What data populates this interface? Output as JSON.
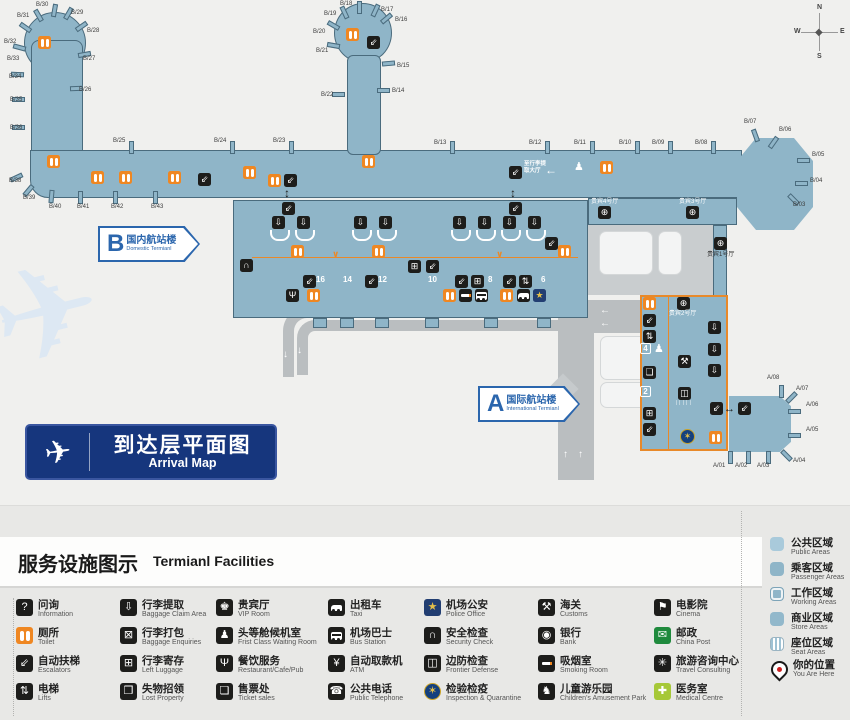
{
  "colors": {
    "terminal_fill": "#8fb5c8",
    "terminal_border": "#4a6b7d",
    "toilet_orange": "#ef8722",
    "road_gray": "#babec0",
    "banner_navy": "#16367d",
    "label_blue": "#2b66ad",
    "legend_bg": "#e8e8e6",
    "post_green": "#1f8a3d",
    "medical_green": "#a6c838"
  },
  "map": {
    "compass": {
      "n": "N",
      "e": "E",
      "s": "S",
      "w": "W"
    },
    "banner": {
      "zh": "到达层平面图",
      "en": "Arrival Map"
    },
    "terminal_b": {
      "letter": "B",
      "zh": "国内航站楼",
      "en": "Domestic Termianl"
    },
    "terminal_a": {
      "letter": "A",
      "zh": "国际航站楼",
      "en": "International Termianl"
    },
    "wayfinding_baggage": "至行李提\n取大厅",
    "frontier_hatch": "∣∣∣∣∣",
    "gates": [
      [
        "B/30",
        36,
        2,
        52,
        4,
        10
      ],
      [
        "B/31",
        17,
        13,
        36,
        9,
        -30
      ],
      [
        "B/29",
        71,
        10,
        66,
        7,
        30
      ],
      [
        "B/32",
        4,
        39,
        23,
        21,
        -55
      ],
      [
        "B/28",
        87,
        28,
        79,
        20,
        55
      ],
      [
        "B/33",
        7,
        56,
        17,
        41,
        -75
      ],
      [
        "B/27",
        83,
        56,
        82,
        48,
        80
      ],
      [
        "B/34",
        9,
        74,
        15,
        68,
        -88
      ],
      [
        "B/26",
        79,
        87,
        74,
        82,
        88
      ],
      [
        "B/35",
        10,
        97,
        16,
        93,
        -90
      ],
      [
        "B/36",
        10,
        125,
        16,
        121,
        -90
      ],
      [
        "B/38",
        9,
        178,
        14,
        171,
        -115
      ],
      [
        "B/39",
        23,
        195,
        26,
        184,
        -140
      ],
      [
        "B/40",
        49,
        204,
        49,
        190,
        -175
      ],
      [
        "B/41",
        77,
        204,
        78,
        191,
        180
      ],
      [
        "B/42",
        111,
        204,
        113,
        191,
        180
      ],
      [
        "B/43",
        151,
        204,
        153,
        191,
        180
      ],
      [
        "B/25",
        113,
        138,
        129,
        141,
        0
      ],
      [
        "B/24",
        214,
        138,
        230,
        141,
        0
      ],
      [
        "B/23",
        273,
        138,
        289,
        141,
        0
      ],
      [
        "B/18",
        340,
        1,
        357,
        1,
        0
      ],
      [
        "B/17",
        381,
        7,
        373,
        4,
        25
      ],
      [
        "B/19",
        324,
        11,
        342,
        6,
        -25
      ],
      [
        "B/16",
        395,
        17,
        384,
        12,
        50
      ],
      [
        "B/20",
        313,
        29,
        331,
        19,
        -60
      ],
      [
        "B/21",
        316,
        48,
        331,
        39,
        -80
      ],
      [
        "B/15",
        397,
        63,
        386,
        57,
        85
      ],
      [
        "B/22",
        321,
        92,
        336,
        88,
        -90
      ],
      [
        "B/14",
        392,
        88,
        381,
        84,
        90
      ],
      [
        "B/13",
        434,
        140,
        450,
        141,
        0
      ],
      [
        "B/12",
        529,
        140,
        545,
        141,
        0
      ],
      [
        "B/11",
        574,
        140,
        590,
        141,
        0
      ],
      [
        "B/10",
        619,
        140,
        635,
        141,
        0
      ],
      [
        "B/09",
        652,
        140,
        668,
        141,
        0
      ],
      [
        "B/08",
        695,
        140,
        711,
        141,
        0
      ],
      [
        "B/07",
        744,
        119,
        753,
        129,
        -20
      ],
      [
        "B/06",
        779,
        127,
        771,
        136,
        35
      ],
      [
        "B/05",
        812,
        152,
        801,
        154,
        90
      ],
      [
        "B/04",
        810,
        178,
        799,
        177,
        90
      ],
      [
        "B/03",
        793,
        202,
        791,
        193,
        135
      ],
      [
        "A/08",
        767,
        375,
        779,
        385,
        0
      ],
      [
        "A/07",
        796,
        386,
        789,
        391,
        45
      ],
      [
        "A/06",
        806,
        402,
        792,
        405,
        90
      ],
      [
        "A/05",
        806,
        427,
        792,
        429,
        90
      ],
      [
        "A/04",
        793,
        458,
        784,
        449,
        135
      ],
      [
        "A/03",
        757,
        463,
        766,
        451,
        180
      ],
      [
        "A/02",
        735,
        463,
        746,
        451,
        180
      ],
      [
        "A/01",
        713,
        463,
        728,
        451,
        180
      ]
    ],
    "icons": [
      [
        "wc",
        38,
        36
      ],
      [
        "wc",
        47,
        155
      ],
      [
        "wc",
        91,
        171
      ],
      [
        "wc",
        119,
        171
      ],
      [
        "wc",
        168,
        171
      ],
      [
        "esc",
        198,
        173
      ],
      [
        "wc",
        243,
        166
      ],
      [
        "wc",
        268,
        174
      ],
      [
        "esc",
        284,
        174
      ],
      [
        "wc",
        346,
        28
      ],
      [
        "esc",
        367,
        36
      ],
      [
        "wc",
        362,
        155
      ],
      [
        "esc",
        509,
        166
      ],
      [
        "arrowL",
        545,
        164
      ],
      [
        "person",
        574,
        162
      ],
      [
        "wc",
        600,
        161
      ],
      [
        "updown",
        284,
        187
      ],
      [
        "updown",
        510,
        187
      ],
      [
        "esc",
        282,
        202
      ],
      [
        "esc",
        509,
        202
      ],
      [
        "bag",
        272,
        216
      ],
      [
        "bag",
        297,
        216
      ],
      [
        "bag",
        354,
        216
      ],
      [
        "bag",
        379,
        216
      ],
      [
        "bag",
        453,
        216
      ],
      [
        "bag",
        478,
        216
      ],
      [
        "bag",
        503,
        216
      ],
      [
        "bag",
        528,
        216
      ],
      [
        "wc",
        291,
        245
      ],
      [
        "wc",
        372,
        245
      ],
      [
        "wc",
        558,
        245
      ],
      [
        "aD",
        332,
        250
      ],
      [
        "aD",
        496,
        250
      ],
      [
        "sec",
        240,
        259
      ],
      [
        "lug",
        408,
        260
      ],
      [
        "esc",
        426,
        260
      ],
      [
        "esc",
        303,
        275
      ],
      [
        "esc",
        365,
        275
      ],
      [
        "esc",
        455,
        275
      ],
      [
        "lug",
        471,
        275
      ],
      [
        "esc",
        503,
        275
      ],
      [
        "lift",
        519,
        275
      ],
      [
        "esc",
        545,
        237
      ],
      [
        "rest",
        286,
        289
      ],
      [
        "wc",
        307,
        289
      ],
      [
        "wc",
        443,
        289
      ],
      [
        "smoke",
        459,
        289
      ],
      [
        "bus",
        475,
        289
      ],
      [
        "wc",
        500,
        289
      ],
      [
        "taxi",
        517,
        289
      ],
      [
        "police",
        533,
        289
      ],
      [
        "vip",
        598,
        206
      ],
      [
        "vip",
        686,
        206
      ],
      [
        "vip",
        714,
        237
      ],
      [
        "wc",
        643,
        297
      ],
      [
        "esc",
        643,
        314
      ],
      [
        "lift",
        643,
        330
      ],
      [
        "tick",
        643,
        366
      ],
      [
        "lug",
        643,
        407
      ],
      [
        "esc",
        643,
        423
      ],
      [
        "person",
        654,
        344
      ],
      [
        "vip",
        677,
        297
      ],
      [
        "cust",
        678,
        355
      ],
      [
        "fron",
        678,
        387
      ],
      [
        "bag",
        708,
        321
      ],
      [
        "bag",
        708,
        343
      ],
      [
        "bag",
        708,
        364
      ],
      [
        "esc",
        710,
        402
      ],
      [
        "lr",
        724,
        404
      ],
      [
        "esc",
        738,
        402
      ],
      [
        "insp",
        680,
        429
      ],
      [
        "wc",
        709,
        431
      ]
    ],
    "badges": [
      [
        "4",
        640,
        343
      ],
      [
        "2",
        640,
        386
      ]
    ],
    "exit_numbers": [
      [
        "16",
        316,
        276
      ],
      [
        "14",
        343,
        276
      ],
      [
        "12",
        378,
        276
      ],
      [
        "10",
        428,
        276
      ],
      [
        "8",
        488,
        276
      ],
      [
        "6",
        541,
        276
      ]
    ],
    "vip_labels": [
      [
        "贵宾4号厅",
        591,
        199,
        "w"
      ],
      [
        "贵宾3号厅",
        679,
        199,
        "w"
      ],
      [
        "贵宾1号厅",
        707,
        252,
        "d"
      ],
      [
        "贵宾2号厅",
        669,
        311,
        "w"
      ]
    ],
    "road_arrows": [
      [
        "↓",
        283,
        350
      ],
      [
        "↓",
        297,
        346
      ],
      [
        "←",
        600,
        306
      ],
      [
        "←",
        600,
        319
      ],
      [
        "↑",
        563,
        450
      ],
      [
        "↑",
        578,
        450
      ]
    ],
    "carousel_x": [
      270,
      295,
      352,
      377,
      451,
      476,
      501,
      526
    ],
    "carousel_y": 230,
    "exit_stub_x": [
      313,
      340,
      375,
      425,
      484,
      537
    ]
  },
  "legend": {
    "title_zh": "服务设施图示",
    "title_en": "Termianl Facilities",
    "rows_y": [
      598,
      626,
      654,
      682
    ],
    "columns": [
      {
        "x": 16,
        "items": [
          {
            "name": "information",
            "glyph": "?",
            "zh": "问询",
            "en": "Information"
          },
          {
            "name": "toilet",
            "shape": "wc",
            "bg": "#ef8722",
            "zh": "厕所",
            "en": "Toilet"
          },
          {
            "name": "escalators",
            "glyph": "⇙",
            "zh": "自动扶梯",
            "en": "Escalators"
          },
          {
            "name": "lifts",
            "glyph": "⇅",
            "zh": "电梯",
            "en": "Lifts"
          }
        ]
      },
      {
        "x": 120,
        "items": [
          {
            "name": "baggage-claim",
            "glyph": "⇩",
            "zh": "行李提取",
            "en": "Baggage Claim Area"
          },
          {
            "name": "baggage-enquiries",
            "glyph": "⊠",
            "zh": "行李打包",
            "en": "Baggage Enquiries"
          },
          {
            "name": "left-luggage",
            "glyph": "⊞",
            "zh": "行李寄存",
            "en": "Left Luggage"
          },
          {
            "name": "lost-property",
            "glyph": "❒",
            "zh": "失物招领",
            "en": "Lost Property"
          }
        ]
      },
      {
        "x": 216,
        "items": [
          {
            "name": "vip-room",
            "glyph": "♚",
            "zh": "贵宾厅",
            "en": "VIP Room"
          },
          {
            "name": "first-class-waiting-room",
            "glyph": "♟",
            "zh": "头等舱候机室",
            "en": "Frist Class Waiting Room"
          },
          {
            "name": "restaurant",
            "glyph": "Ψ",
            "zh": "餐饮服务",
            "en": "Restaurant/Cafe/Pub"
          },
          {
            "name": "ticket-sales",
            "glyph": "❏",
            "zh": "售票处",
            "en": "Ticket sales"
          }
        ]
      },
      {
        "x": 328,
        "items": [
          {
            "name": "taxi",
            "shape": "car",
            "zh": "出租车",
            "en": "Taxi"
          },
          {
            "name": "bus-station",
            "shape": "bus",
            "zh": "机场巴士",
            "en": "Bus Station"
          },
          {
            "name": "atm",
            "glyph": "¥",
            "zh": "自动取款机",
            "en": "ATM"
          },
          {
            "name": "public-telephone",
            "glyph": "☎",
            "zh": "公共电话",
            "en": "Public Telephone"
          }
        ]
      },
      {
        "x": 424,
        "items": [
          {
            "name": "police-office",
            "glyph": "★",
            "bg": "#223e72",
            "fg": "#e4bf4a",
            "zh": "机场公安",
            "en": "Police Office"
          },
          {
            "name": "security-check",
            "glyph": "∩",
            "zh": "安全检查",
            "en": "Security Check"
          },
          {
            "name": "frontier-defense",
            "glyph": "◫",
            "zh": "边防检查",
            "en": "Frontier Defense"
          },
          {
            "name": "inspection-quarantine",
            "glyph": "✶",
            "bg": "#14407e",
            "fg": "#e4bf4a",
            "round": true,
            "zh": "检验检疫",
            "en": "Inspection & Quarantine"
          }
        ]
      },
      {
        "x": 538,
        "items": [
          {
            "name": "customs",
            "glyph": "⚒",
            "zh": "海关",
            "en": "Customs"
          },
          {
            "name": "bank",
            "glyph": "◉",
            "zh": "银行",
            "en": "Bank"
          },
          {
            "name": "smoking-room",
            "shape": "cig",
            "zh": "吸烟室",
            "en": "Smoking Room"
          },
          {
            "name": "children-amusement-park",
            "glyph": "♞",
            "zh": "儿童游乐园",
            "en": "Children's Amusement Park"
          }
        ]
      },
      {
        "x": 654,
        "items": [
          {
            "name": "cinema",
            "glyph": "⚑",
            "zh": "电影院",
            "en": "Cinema"
          },
          {
            "name": "china-post",
            "glyph": "✉",
            "bg": "#1f8a3d",
            "zh": "邮政",
            "en": "China Post"
          },
          {
            "name": "travel-consulting",
            "glyph": "✳",
            "zh": "旅游咨询中心",
            "en": "Travel Consulting"
          },
          {
            "name": "medical-centre",
            "glyph": "✚",
            "bg": "#a6c838",
            "zh": "医务室",
            "en": "Medical Centre"
          }
        ]
      }
    ],
    "areas_y": [
      536,
      561,
      586,
      611,
      636
    ],
    "areas": [
      {
        "style": "public",
        "zh": "公共区域",
        "en": "Public Areas"
      },
      {
        "style": "passenger",
        "zh": "乘客区域",
        "en": "Passenger Areas"
      },
      {
        "style": "working",
        "zh": "工作区域",
        "en": "Working Areas"
      },
      {
        "style": "store",
        "zh": "商业区域",
        "en": "Store Areas"
      },
      {
        "style": "seat",
        "zh": "座位区域",
        "en": "Seat Areas"
      }
    ],
    "you_are_here": {
      "zh": "你的位置",
      "en": "You Are Here"
    }
  }
}
